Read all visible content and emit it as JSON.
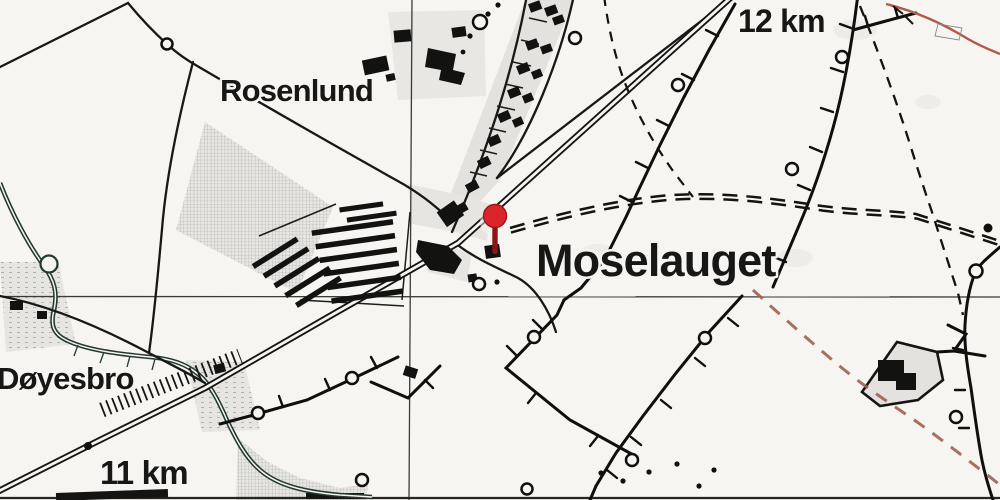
{
  "map": {
    "title": "Historisk målebordsblad – Moselauget Trinbræt",
    "labels": {
      "place_main": "Moselauget",
      "village": "Rosenlund",
      "bridge": "Døyesbro",
      "km_marker_low": "11 km",
      "km_marker_high": "12 km"
    },
    "marker": {
      "name": "Moselauget station pin",
      "color": "#d9252b",
      "stem_color": "#8c1518"
    },
    "colors": {
      "paper": "#f6f5f2",
      "ink": "#171715",
      "water": "#23382f",
      "boundary_red": "#a2604c",
      "boundary_red_solid": "#b45848",
      "fill_gray": "#e3e2de"
    }
  }
}
